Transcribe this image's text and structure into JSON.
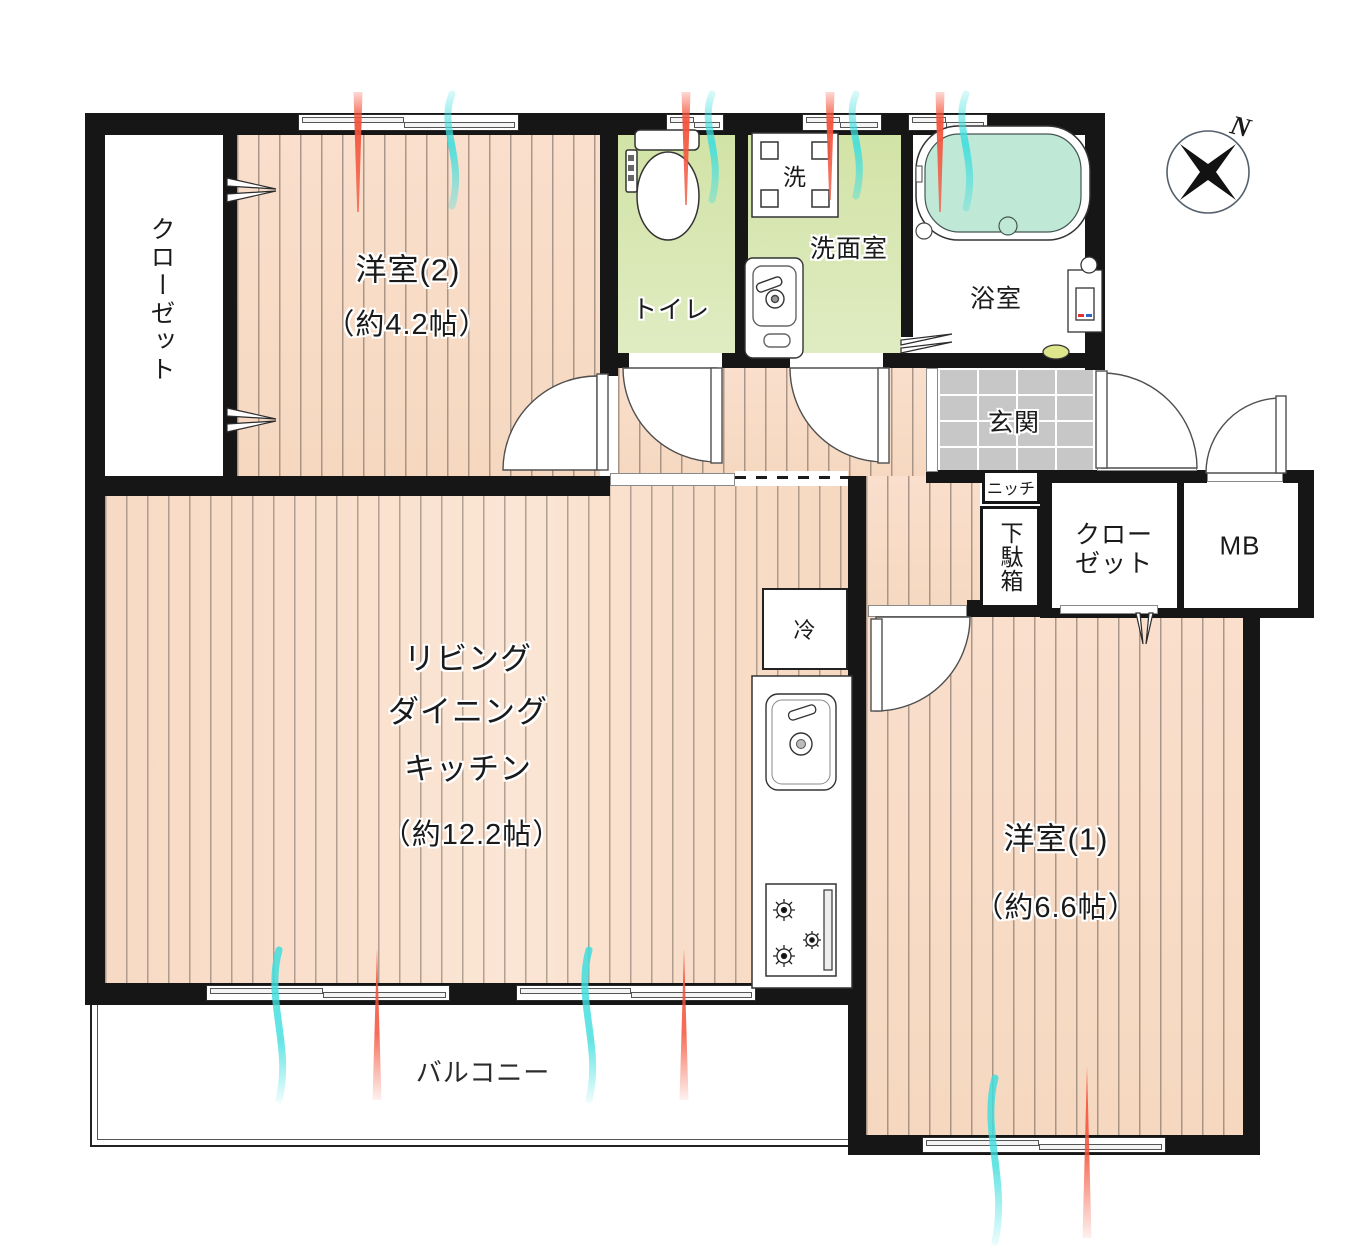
{
  "title": "2LDK apartment floor plan",
  "rooms": {
    "closet_left": {
      "label": "クローゼット"
    },
    "bedroom2": {
      "name": "洋室(2)",
      "size": "（約4.2帖）"
    },
    "toilet": {
      "label": "トイレ"
    },
    "washroom": {
      "label": "洗面室",
      "washer": "洗"
    },
    "bathroom": {
      "label": "浴室"
    },
    "entrance": {
      "label": "玄関"
    },
    "niche": {
      "label": "ニッチ"
    },
    "shoe_cabinet": {
      "label": "下駄箱"
    },
    "hall_closet": {
      "line1": "クロー",
      "line2": "ゼット"
    },
    "meter_box": {
      "label": "MB"
    },
    "ldk": {
      "line1": "リビング",
      "line2": "ダイニング",
      "line3": "キッチン",
      "size": "（約12.2帖）"
    },
    "bedroom1": {
      "name": "洋室(1)",
      "size": "（約6.6帖）"
    },
    "balcony": {
      "label": "バルコニー"
    },
    "kitchen": {
      "fridge": "冷"
    }
  },
  "compass": {
    "north": "N"
  },
  "colors": {
    "wall": "#161616",
    "floor_wood": "#f8dcc7",
    "floor_green": "#d8e6b4",
    "tile_gray": "#c7c7c7",
    "bath_water": "#bfe8d6",
    "vent_warm": "#f4523a",
    "vent_cool": "#3fdede"
  }
}
